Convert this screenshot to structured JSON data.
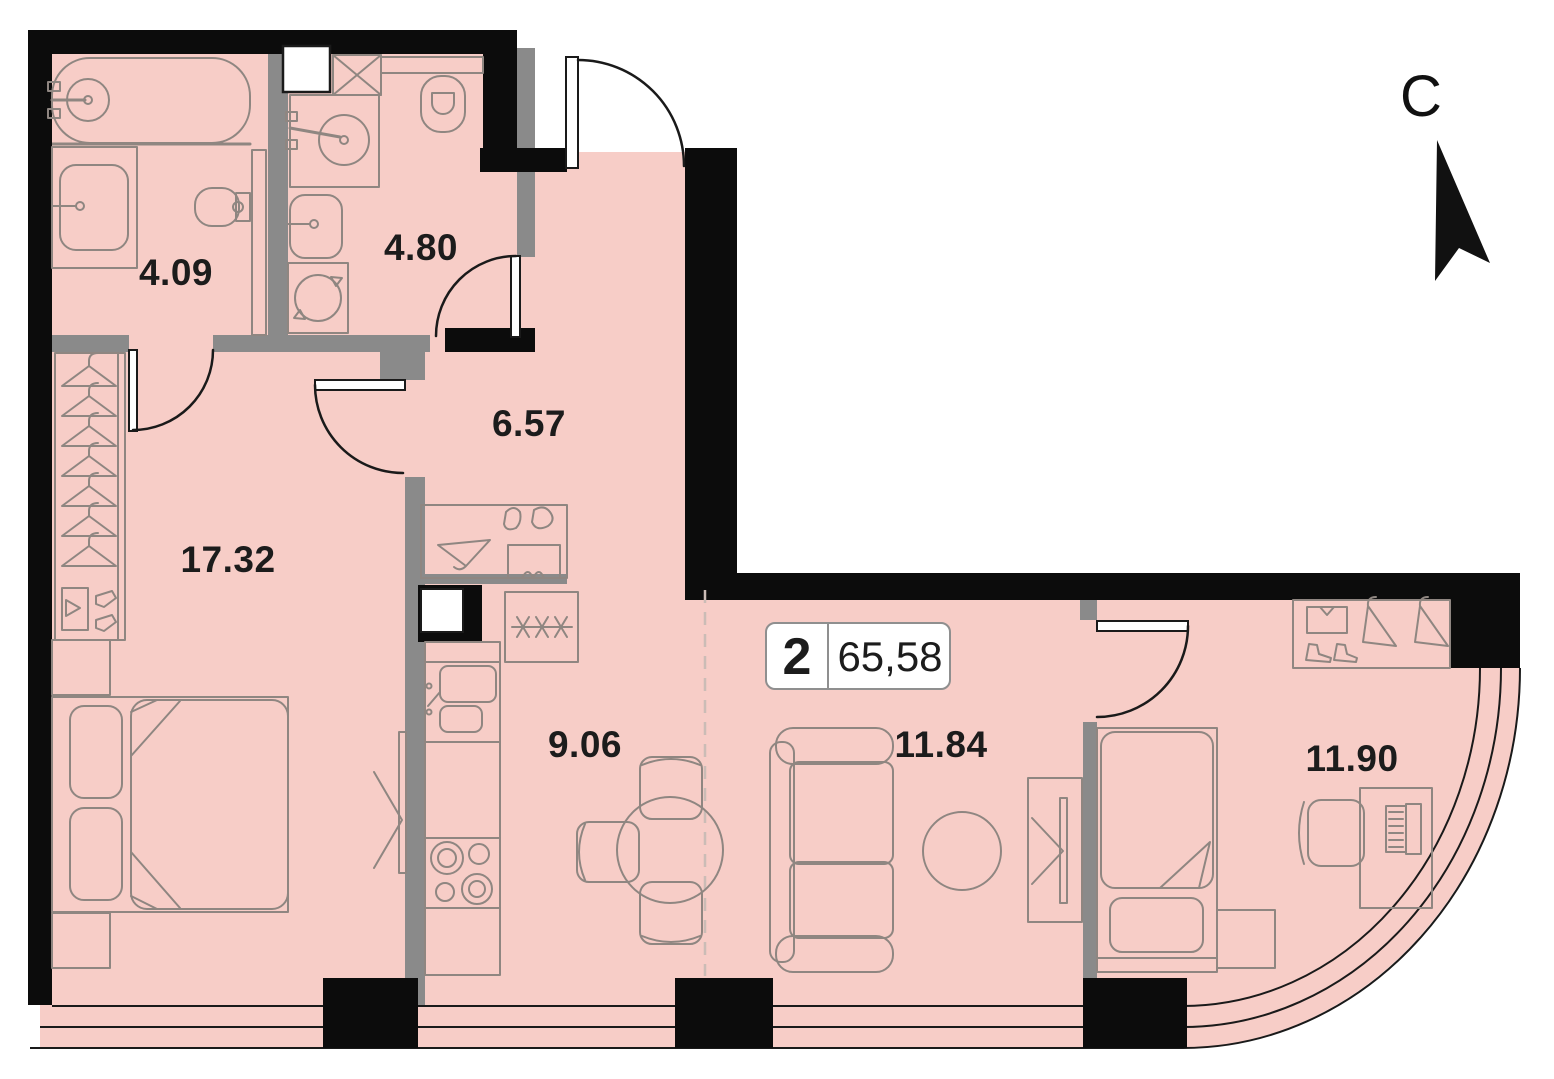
{
  "plan": {
    "north_label": "С",
    "badge": {
      "rooms_count": "2",
      "total_area": "65,58"
    },
    "rooms": [
      {
        "name": "bathroom-1",
        "area": "4.09"
      },
      {
        "name": "bathroom-2",
        "area": "4.80"
      },
      {
        "name": "hallway",
        "area": "6.57"
      },
      {
        "name": "master-bedroom",
        "area": "17.32"
      },
      {
        "name": "kitchen",
        "area": "9.06"
      },
      {
        "name": "living-room",
        "area": "11.84"
      },
      {
        "name": "bedroom",
        "area": "11.90"
      }
    ],
    "colors": {
      "floor": "#f7cdc7",
      "wall_black": "#0c0c0c",
      "wall_gray": "#8a8a8a",
      "furniture_line": "#8f8681",
      "text": "#1c1c1c",
      "badge_border": "#8f8f8f"
    },
    "icons": [
      "north-arrow-icon",
      "bathtub-icon",
      "toilet-icon",
      "sink-icon",
      "shower-icon",
      "washing-machine-icon",
      "vent-shaft-icon",
      "hanger-icon",
      "shoes-icon",
      "bed-icon",
      "pillow-icon",
      "tv-icon",
      "fridge-icon",
      "stove-icon",
      "kitchen-sink-icon",
      "dining-table-icon",
      "chair-icon",
      "sofa-icon",
      "coffee-table-icon",
      "wardrobe-icon",
      "desk-icon",
      "office-chair-icon",
      "laptop-icon",
      "door-arc-icon"
    ]
  }
}
